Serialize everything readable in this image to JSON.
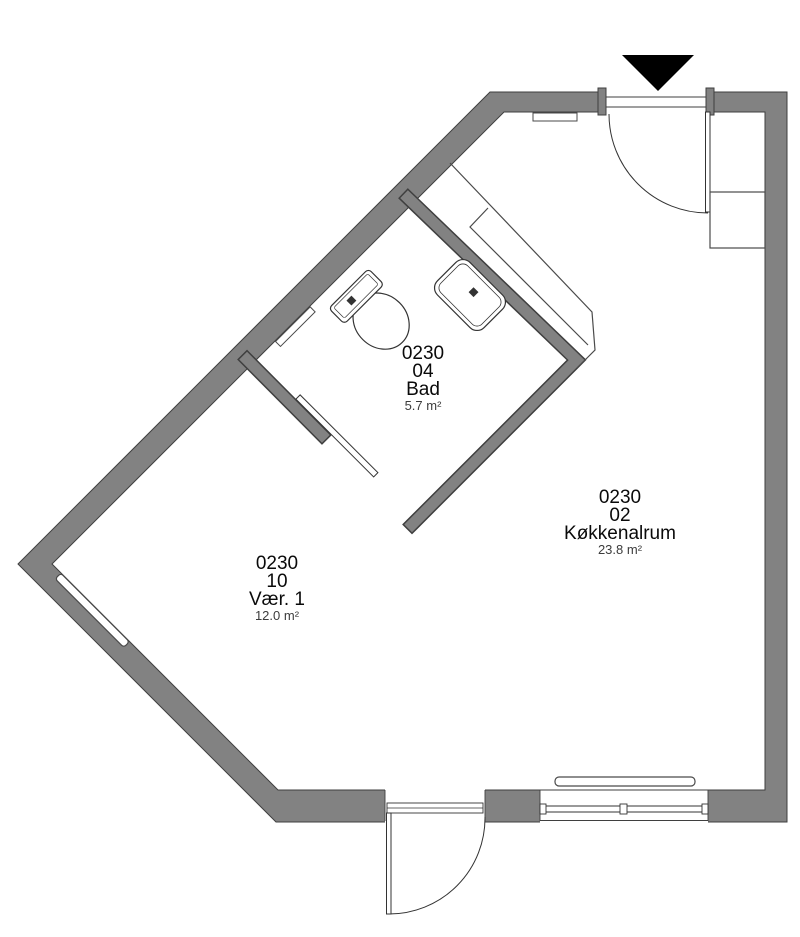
{
  "plan": {
    "title": "Apartment floor plan",
    "rooms": [
      {
        "id": "0230",
        "unit": "04",
        "name": "Bad",
        "area": "5.7 m²"
      },
      {
        "id": "0230",
        "unit": "02",
        "name": "Køkkenalrum",
        "area": "23.8 m²"
      },
      {
        "id": "0230",
        "unit": "10",
        "name": "Vær. 1",
        "area": "12.0 m²"
      }
    ],
    "colors": {
      "wall_fill": "#828282",
      "wall_outline": "#3f3f3f",
      "fixture_line": "#333333",
      "entrance_marker": "#000000",
      "background": "#ffffff"
    },
    "markers": {
      "entrance_marker": "entrance-triangle"
    }
  }
}
